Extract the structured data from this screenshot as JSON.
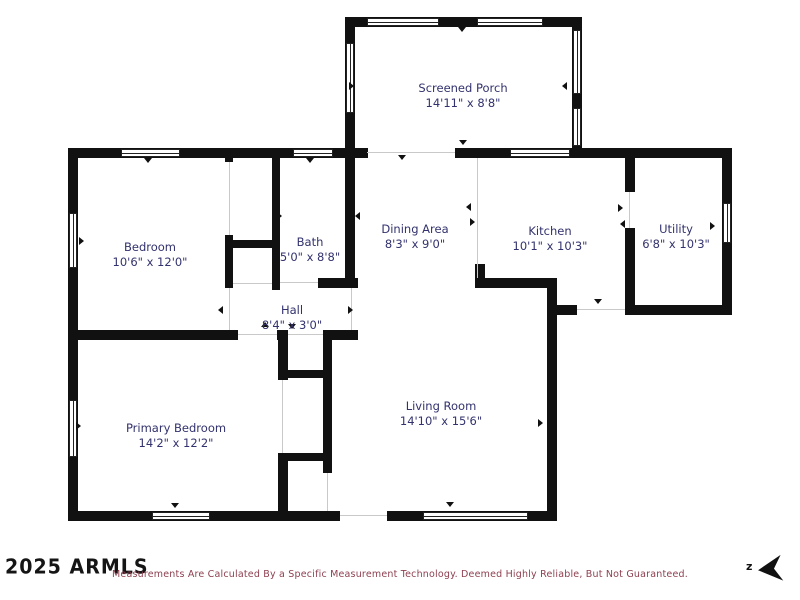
{
  "plan_title": "Residential Floor Plan",
  "rooms": [
    {
      "id": "screened-porch",
      "name": "Screened Porch",
      "dims": "14'11\" x 8'8\""
    },
    {
      "id": "bedroom",
      "name": "Bedroom",
      "dims": "10'6\" x 12'0\""
    },
    {
      "id": "bath",
      "name": "Bath",
      "dims": "5'0\" x 8'8\""
    },
    {
      "id": "dining-area",
      "name": "Dining Area",
      "dims": "8'3\" x 9'0\""
    },
    {
      "id": "kitchen",
      "name": "Kitchen",
      "dims": "10'1\" x 10'3\""
    },
    {
      "id": "utility",
      "name": "Utility",
      "dims": "6'8\" x 10'3\""
    },
    {
      "id": "hall",
      "name": "Hall",
      "dims": "8'4\" x 3'0\""
    },
    {
      "id": "primary-bedroom",
      "name": "Primary Bedroom",
      "dims": "14'2\" x 12'2\""
    },
    {
      "id": "living-room",
      "name": "Living Room",
      "dims": "14'10\" x 15'6\""
    }
  ],
  "branding": {
    "watermark": "2025 ARMLS"
  },
  "footer": {
    "disclaimer": "Measurements Are Calculated By a Specific Measurement Technology. Deemed Highly Reliable, But Not Guaranteed."
  },
  "compass": {
    "label": "z"
  },
  "colors": {
    "wall": "#111111",
    "room_label": "#32326e",
    "disclaimer_text": "#8e4050",
    "watermark": "#151515"
  }
}
